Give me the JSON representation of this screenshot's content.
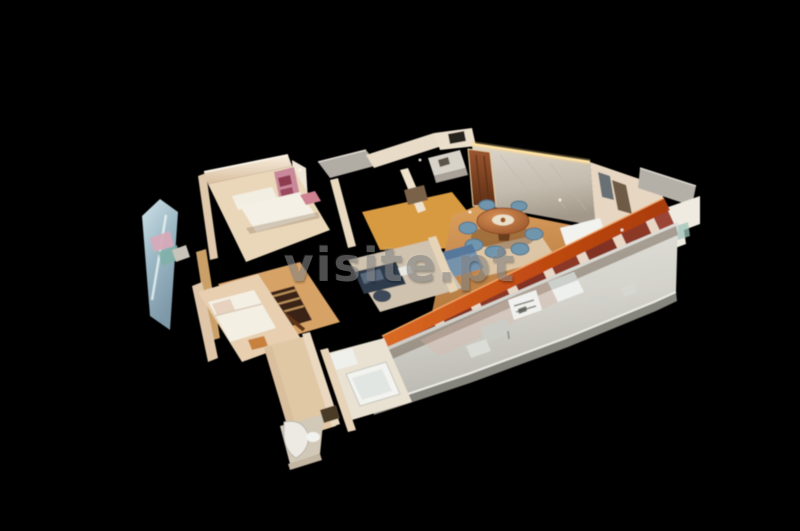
{
  "scene": {
    "kind": "3d-dollhouse-tour-render",
    "description": "Cutaway 3D dollhouse view of a furnished apartment with a long front balcony, seen from above at an angle against a black background",
    "background_color": "#000000"
  },
  "watermark": {
    "text": "visite.pt",
    "color": "#828282"
  },
  "palette": {
    "wall_cream": "#ecdcc7",
    "wall_shadow": "#c9ad8d",
    "back_wall_gray": "#c8c2b8",
    "floor_wood": "#c98e52",
    "floor_light": "#e8d5b5",
    "hall_orange": "#d89a3f",
    "facade_orange": "#c65318",
    "facade_orange_light": "#f5a967",
    "window_glass_red": "#7e2f1f",
    "window_frame": "#f0e4d2",
    "balcony_slab": "#d7d6cf",
    "balcony_edge": "#85847d",
    "glass_pane_blue": "#a6c0cb",
    "furniture_white": "#f1efe8",
    "chair_blue": "#6f96ad",
    "table_copper": "#bd7038",
    "wood_dark": "#6d3f1e",
    "led_strip_warm": "#ffe2a2",
    "stair_hole": "#3a2414"
  }
}
